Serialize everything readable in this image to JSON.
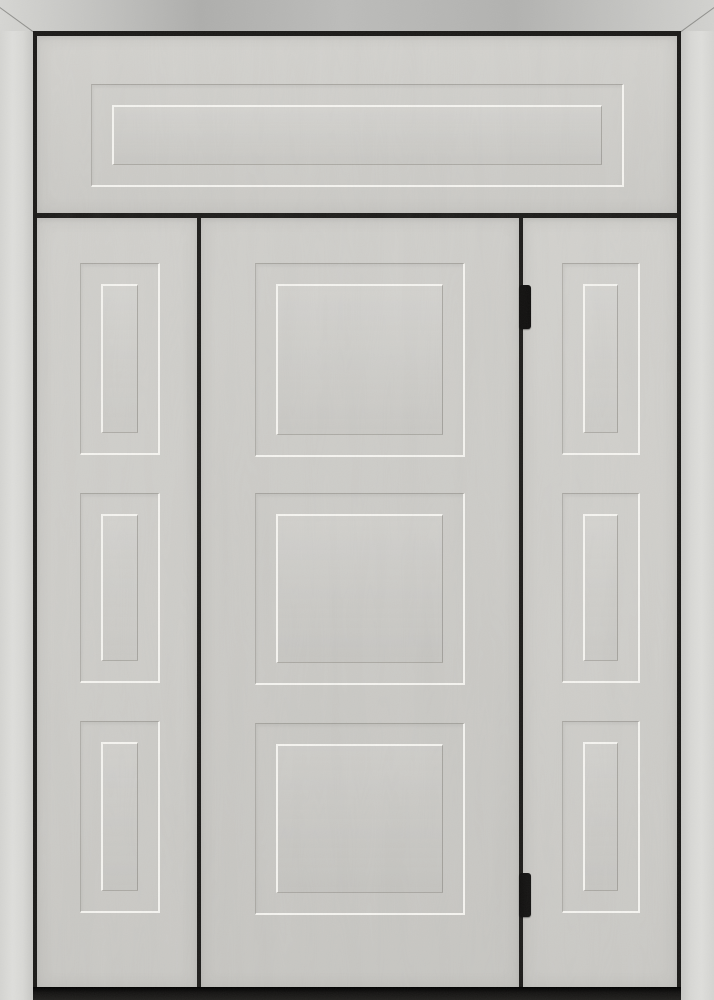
{
  "meta": {
    "content_type": "product-photo",
    "subject": "entry-door-with-two-sidelites-and-transom",
    "visible_text": []
  },
  "door": {
    "colors": {
      "frame_metal": "#d6d6d3",
      "black_trim": "#1b1a18",
      "door_face": "#cbcac6",
      "transom_face": "#d1d0cc",
      "sidelite_face": "#cfceca",
      "panel_highlight": "#f6f5f1",
      "panel_groove": "rgba(110,107,100,0.40)",
      "hinge": "#0e0d0c",
      "sill": "#151413"
    },
    "structure": {
      "transom_panel_count": 1,
      "sidelite_panel_count": 3,
      "door_panel_count": 3,
      "hinge_count": 2,
      "handle_present": false
    },
    "panel_inner_inset": 20,
    "sections": {
      "transom": {
        "panels": [
          {
            "x": 54,
            "y": 48,
            "w": 533,
            "h": 103
          }
        ]
      },
      "left_sidelite": {
        "panels": [
          {
            "x": 43,
            "y": 45,
            "w": 80,
            "h": 192
          },
          {
            "x": 43,
            "y": 275,
            "w": 80,
            "h": 190
          },
          {
            "x": 43,
            "y": 503,
            "w": 80,
            "h": 192
          }
        ]
      },
      "center_door": {
        "panels": [
          {
            "x": 54,
            "y": 45,
            "w": 210,
            "h": 194
          },
          {
            "x": 54,
            "y": 275,
            "w": 210,
            "h": 192
          },
          {
            "x": 54,
            "y": 505,
            "w": 210,
            "h": 192
          }
        ]
      },
      "right_sidelite": {
        "panels": [
          {
            "x": 39,
            "y": 45,
            "w": 78,
            "h": 192
          },
          {
            "x": 39,
            "y": 275,
            "w": 78,
            "h": 190
          },
          {
            "x": 39,
            "y": 503,
            "w": 78,
            "h": 192
          }
        ]
      }
    },
    "hinges": [
      {
        "x": 519,
        "y": 285,
        "w": 12,
        "h": 44
      },
      {
        "x": 519,
        "y": 873,
        "w": 12,
        "h": 44
      }
    ]
  }
}
